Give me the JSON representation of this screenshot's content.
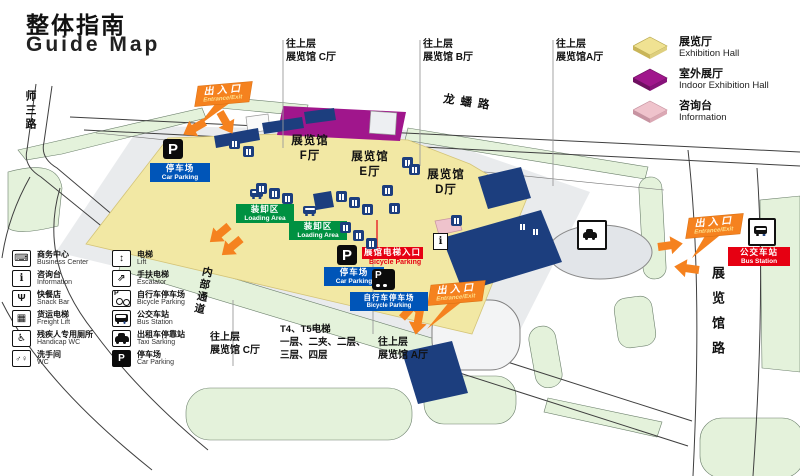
{
  "title": {
    "zh": "整体指南",
    "en": "Guide Map"
  },
  "legend": {
    "items": [
      {
        "name": "exhibition-hall",
        "zh": "展览厅",
        "en": "Exhibition Hall",
        "color": "#F0E292",
        "edge": "#C9B558"
      },
      {
        "name": "outdoor-exhibition-hall",
        "zh": "室外展厅",
        "en": "Indoor Exhibition Hall",
        "color": "#A0168C",
        "edge": "#6E0F60"
      },
      {
        "name": "information",
        "zh": "咨询台",
        "en": "Information",
        "color": "#EFC3CC",
        "edge": "#C793A1"
      }
    ]
  },
  "facilities": {
    "col1": [
      {
        "name": "business-center",
        "zh": "商务中心",
        "en": "Business Center",
        "glyph": "⌨"
      },
      {
        "name": "information",
        "zh": "咨询台",
        "en": "Information",
        "glyph": "i"
      },
      {
        "name": "snack-bar",
        "zh": "快餐店",
        "en": "Snack Bar",
        "glyph": "Ψ"
      },
      {
        "name": "freight-lift",
        "zh": "货运电梯",
        "en": "Freight Lift",
        "glyph": "▦"
      },
      {
        "name": "handicap-wc",
        "zh": "残疾人专用厕所",
        "en": "Handicap WC",
        "glyph": "♿"
      },
      {
        "name": "wc",
        "zh": "洗手间",
        "en": "WC",
        "glyph": "♂♀"
      }
    ],
    "col2": [
      {
        "name": "lift",
        "zh": "电梯",
        "en": "Lift",
        "glyph": "↕"
      },
      {
        "name": "escalator",
        "zh": "手扶电梯",
        "en": "Escalator",
        "glyph": "⇗"
      },
      {
        "name": "bicycle-parking",
        "zh": "自行车停车场",
        "en": "Bicycle Parking",
        "glyph": "P"
      },
      {
        "name": "bus-station",
        "zh": "公交车站",
        "en": "Bus Station",
        "glyph": ""
      },
      {
        "name": "taxi-stand",
        "zh": "出租车停靠站",
        "en": "Taxi Sarking",
        "glyph": ""
      },
      {
        "name": "car-parking",
        "zh": "停车场",
        "en": "Car Parking",
        "glyph": "P"
      }
    ]
  },
  "map": {
    "roads": {
      "top": "龙蟠路",
      "left": "师三路",
      "internal": "内部通道",
      "right": "展览馆路"
    },
    "halls": {
      "f": {
        "zh": "展览馆",
        "no": "F厅"
      },
      "e": {
        "zh": "展览馆",
        "no": "E厅"
      },
      "d": {
        "zh": "展览馆",
        "no": "D厅"
      }
    },
    "links": {
      "c_top": {
        "l1": "往上层",
        "l2": "展览馆 C厅"
      },
      "b_top": {
        "l1": "往上层",
        "l2": "展览馆 B厅"
      },
      "a_top": {
        "l1": "往上层",
        "l2": "展览馆A厅"
      },
      "c_bottom": {
        "l1": "往上层",
        "l2": "展览馆 C厅"
      },
      "a_bottom": {
        "l1": "往上层",
        "l2": "展览馆 A厅"
      }
    },
    "t4t5": {
      "l1": "T4、T5电梯",
      "l2": "一层、二夹、二层、",
      "l3": "三层、四层"
    },
    "entrance": {
      "zh": "出入口",
      "en": "Entrance/Exit"
    },
    "car_parking": {
      "zh": "停车场",
      "en": "Car Parking"
    },
    "bicycle_parking": {
      "zh": "自行车停车场",
      "en": "Bicycle Parking"
    },
    "loading_area": {
      "zh": "装卸区",
      "en": "Loading Area"
    },
    "bus_station": {
      "zh": "公交车站",
      "en": "Bus Station"
    },
    "lift_entrance": {
      "zh": "展馆电梯入口",
      "en": "Bicycle Parking"
    },
    "p_glyph": "P",
    "i_glyph": "i"
  },
  "colors": {
    "orange": "#F5821F",
    "navy": "#1C3E7E",
    "hall_yellow": "#F2E8A4",
    "magenta": "#A0168C",
    "pink": "#EFC3CC",
    "label_blue": "#0055B8",
    "label_green": "#009141",
    "label_red": "#E60012",
    "land_green": "#E4F2DB"
  }
}
